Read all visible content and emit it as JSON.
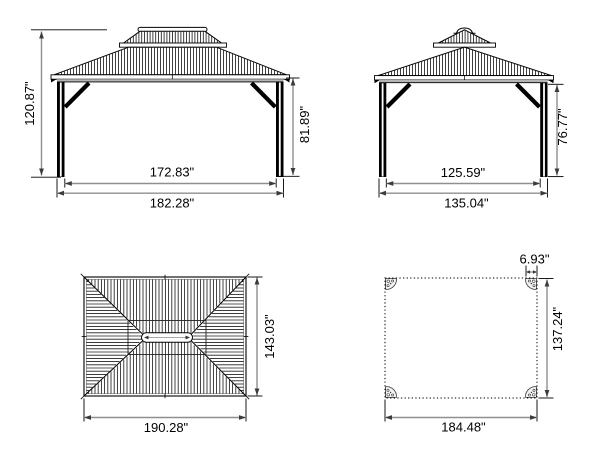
{
  "page": {
    "background": "#ffffff"
  },
  "drawing": {
    "type": "gazebo dimension drawing",
    "line_color": "#000000",
    "dim_line_color": "#8f8f8f",
    "views": {
      "front_elevation": {
        "dims": {
          "overall_height": "120.87\"",
          "clearance_height": "81.89\"",
          "inner_width": "172.83\"",
          "outer_width": "182.28\""
        }
      },
      "side_elevation": {
        "dims": {
          "clearance_height": "76.77\"",
          "inner_depth": "125.59\"",
          "outer_depth": "135.04\""
        }
      },
      "roof_plan": {
        "dims": {
          "roof_depth": "143.03\"",
          "roof_width": "190.28\""
        }
      },
      "floor_plan": {
        "dims": {
          "post_width": "6.93\"",
          "footprint_depth": "137.24\"",
          "footprint_width": "184.48\""
        }
      }
    }
  }
}
